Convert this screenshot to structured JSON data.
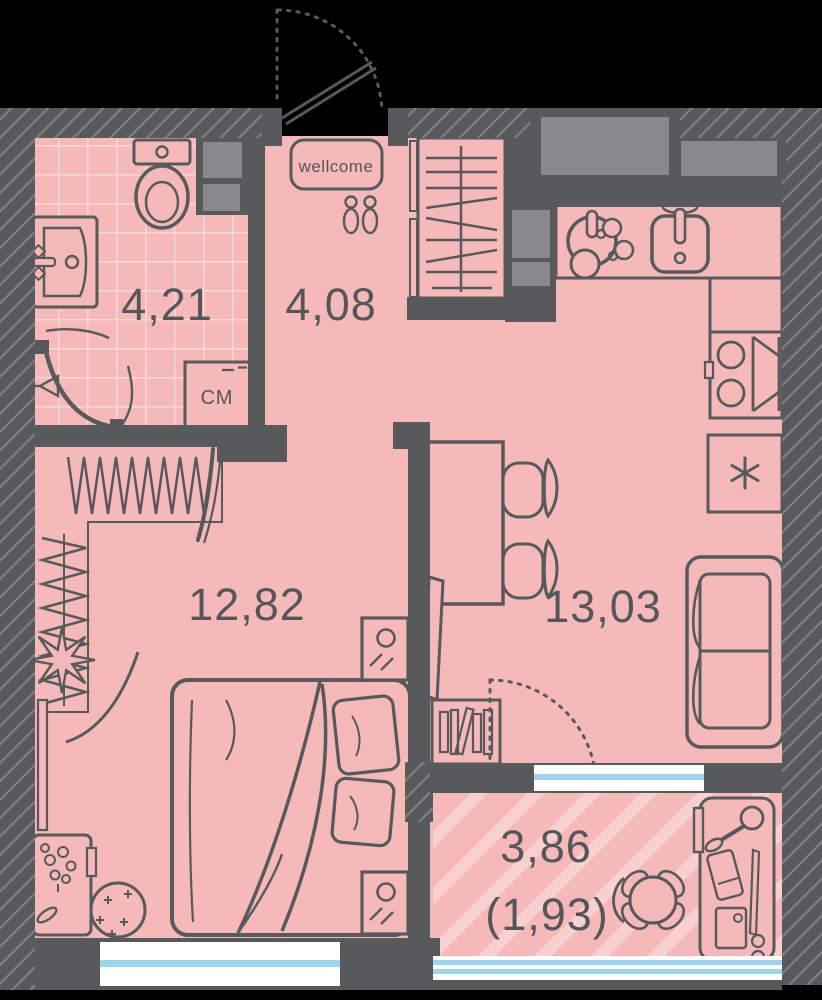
{
  "plan": {
    "type": "studio-apartment-floor-plan",
    "rooms": {
      "bathroom": {
        "area": "4,21"
      },
      "hallway": {
        "area": "4,08"
      },
      "bedroom": {
        "area": "12,82"
      },
      "kitchen_living": {
        "area": "13,03"
      },
      "balcony": {
        "area": "3,86",
        "area_coefficient": "(1,93)"
      }
    },
    "labels": {
      "doormat": "wellcome",
      "washing_machine": "СМ"
    },
    "icons": {
      "fridge_symbol": "✳",
      "entrance_door": "door-swing-arc",
      "balcony_door": "dotted-door-swing-arc"
    },
    "colors": {
      "background": "#000000",
      "wall": "#58595b",
      "wall_hatch_line": "#7e8084",
      "floor_pink": "#f6b9b9",
      "tile_line": "#fbd8d8",
      "balcony_stripe": "#f9d0d0",
      "shaft_gray": "#87898c",
      "window_glass": "#9ed3ec",
      "text": "#55565a"
    }
  }
}
